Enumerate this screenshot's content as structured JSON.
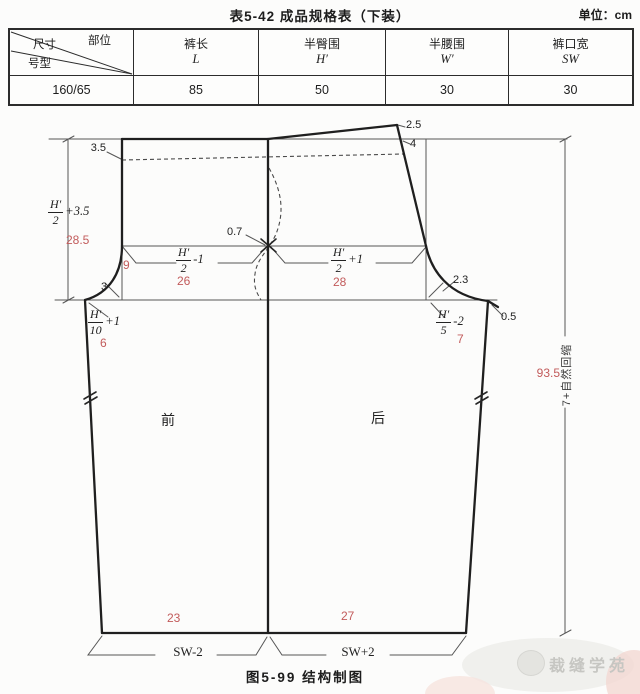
{
  "header": {
    "title": "表5-42 成品规格表（下装）",
    "unit": "单位：cm"
  },
  "spec_table": {
    "corner": {
      "part": "部位",
      "size": "尺寸",
      "model": "号型"
    },
    "columns": [
      {
        "name": "裤长",
        "symbol": "L"
      },
      {
        "name": "半臀围",
        "symbol": "H′"
      },
      {
        "name": "半腰围",
        "symbol": "W′"
      },
      {
        "name": "裤口宽",
        "symbol": "SW"
      }
    ],
    "row": {
      "model": "160/65",
      "values": [
        "85",
        "50",
        "30",
        "30"
      ]
    }
  },
  "diagram": {
    "caption": "图5-99 结构制图",
    "pieces": {
      "front": "前",
      "back": "后"
    },
    "dims": {
      "front_waist_drop": "3.5",
      "back_rise_up": "2.5",
      "back_waist_drop": "4",
      "side_offset": "0.7",
      "back_bisector": "2.3",
      "tip_raise": "0.5",
      "front_bisector": "3"
    },
    "formulas": {
      "rise": {
        "num": "H′",
        "den": "2",
        "suffix": "+3.5"
      },
      "front_hip": {
        "num": "H′",
        "den": "2",
        "suffix": "-1"
      },
      "back_hip": {
        "num": "H′",
        "den": "2",
        "suffix": "+1"
      },
      "front_ext": {
        "num": "H′",
        "den": "10",
        "suffix": "+1"
      },
      "back_ext": {
        "num": "H′",
        "den": "5",
        "suffix": "-2"
      }
    },
    "red_values": {
      "rise": "28.5",
      "front_fold": "9",
      "front_hip": "26",
      "back_hip": "28",
      "front_ext": "6",
      "back_ext": "7",
      "front_hem": "23",
      "back_hem": "27",
      "side_length": "93.5"
    },
    "hem_formulas": {
      "front": "SW-2",
      "back": "SW+2"
    },
    "side_note": "7+自然回缩"
  },
  "watermark": {
    "text": "裁缝学苑"
  },
  "colors": {
    "red": "#c25b5b",
    "line": "#1f1f1f"
  }
}
